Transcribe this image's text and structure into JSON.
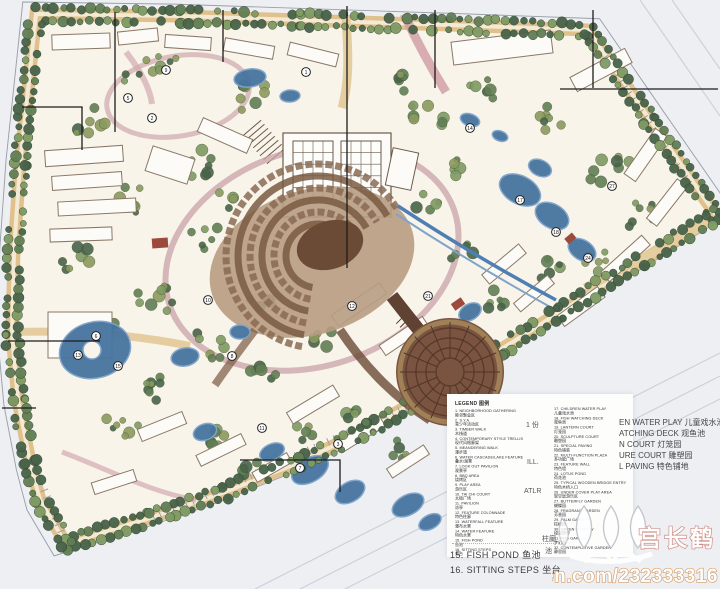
{
  "legend": {
    "heading": "LEGEND 图例",
    "left": [
      {
        "num": "1.",
        "en": "NEIGHBORHOOD GATHERING",
        "zh": "睦邻聚会区"
      },
      {
        "num": "2.",
        "en": "S.Y.A.",
        "zh": "青少年活动区"
      },
      {
        "num": "3.",
        "en": "TIMBER WALK",
        "zh": "木栈道"
      },
      {
        "num": "4.",
        "en": "CONTEMPORARY STYLE TRELLIS",
        "zh": "现代风格廊架"
      },
      {
        "num": "5.",
        "en": "MEANDERING WALK",
        "zh": "漫步道"
      },
      {
        "num": "6.",
        "en": "WATER CASCADE/LAKE FEATURE",
        "zh": "叠水/湖景"
      },
      {
        "num": "7.",
        "en": "LOOK OUT PAVILION",
        "zh": "观景亭"
      },
      {
        "num": "8.",
        "en": "BBQ AREA",
        "zh": "烧烤区"
      },
      {
        "num": "9.",
        "en": "PLAY AREA",
        "zh": "游乐区"
      },
      {
        "num": "10.",
        "en": "TAI CHI COURT",
        "zh": "太极广场"
      },
      {
        "num": "11.",
        "en": "PAVILION",
        "zh": "凉亭"
      },
      {
        "num": "12.",
        "en": "FEATURE COLONNADE",
        "zh": "特色柱廊"
      },
      {
        "num": "13.",
        "en": "WATERFALL FEATURE",
        "zh": "瀑布水景"
      },
      {
        "num": "14.",
        "en": "WATER FEATURE",
        "zh": "特色水景"
      },
      {
        "num": "15.",
        "en": "FISH POND",
        "zh": "鱼池"
      },
      {
        "num": "16.",
        "en": "SITTING STEPS",
        "zh": "坐台"
      }
    ],
    "right": [
      {
        "num": "17.",
        "en": "CHILDREN WATER PLAY",
        "zh": "儿童戏水池"
      },
      {
        "num": "18.",
        "en": "FISH WATCHING DECK",
        "zh": "观鱼池"
      },
      {
        "num": "19.",
        "en": "LANTERN COURT",
        "zh": "灯笼园"
      },
      {
        "num": "20.",
        "en": "SCULPTURE COURT",
        "zh": "雕塑园"
      },
      {
        "num": "21.",
        "en": "SPECIAL PAVING",
        "zh": "特色铺装"
      },
      {
        "num": "22.",
        "en": "MULTI-FUNCTION PLAZA",
        "zh": "多功能广场"
      },
      {
        "num": "23.",
        "en": "FEATURE WALL",
        "zh": "特色墙"
      },
      {
        "num": "24.",
        "en": "LOTUS POND",
        "zh": "荷花池"
      },
      {
        "num": "25.",
        "en": "TYPICAL WOODEN BRIDGE ENTRY",
        "zh": "特色木桥入口"
      },
      {
        "num": "26.",
        "en": "UNDER COVER PLAY AREA",
        "zh": "架空层游乐区"
      },
      {
        "num": "27.",
        "en": "BUTTERFLY GARDEN",
        "zh": "蝴蝶园"
      },
      {
        "num": "28.",
        "en": "FRAGRANT GARDEN",
        "zh": "芳香园"
      },
      {
        "num": "29.",
        "en": "PALM GARDEN",
        "zh": "棕榈园"
      },
      {
        "num": "30.",
        "en": "GREEN MEADOW",
        "zh": "绿茵草坪"
      },
      {
        "num": "31.",
        "en": "FOG GARDEN",
        "zh": "梦幻园"
      },
      {
        "num": "32.",
        "en": "CONTEMPLATIVE GARDEN",
        "zh": "静思园"
      }
    ],
    "bottom_lines": [
      "15. FISH POND 鱼池",
      "16. SITTING STEPS 坐台"
    ],
    "overlay_lines": [
      "EN WATER PLAY 儿童戏水池",
      "ATCHING DECK 观鱼池",
      "N COURT 灯笼园",
      "URE COURT 雕塑园",
      "L PAVING 特色铺地"
    ],
    "fragments": [
      {
        "text": "1 份",
        "x": 526,
        "y": 420
      },
      {
        "text": "ILL.",
        "x": 527,
        "y": 459
      },
      {
        "text": "ATLR",
        "x": 524,
        "y": 488
      },
      {
        "text": "柱廊",
        "x": 542,
        "y": 534
      },
      {
        "text": "池",
        "x": 545,
        "y": 546
      }
    ]
  },
  "watermark": {
    "name": "宫长鹤",
    "url": "renren.com/232333316",
    "logo": "three-cranes-logo"
  },
  "plan": {
    "markers": [
      {
        "n": "1",
        "x": 306,
        "y": 72
      },
      {
        "n": "9",
        "x": 166,
        "y": 70
      },
      {
        "n": "5",
        "x": 128,
        "y": 98
      },
      {
        "n": "2",
        "x": 152,
        "y": 118
      },
      {
        "n": "6",
        "x": 96,
        "y": 336
      },
      {
        "n": "13",
        "x": 78,
        "y": 355
      },
      {
        "n": "15",
        "x": 118,
        "y": 366
      },
      {
        "n": "10",
        "x": 208,
        "y": 300
      },
      {
        "n": "8",
        "x": 232,
        "y": 356
      },
      {
        "n": "11",
        "x": 262,
        "y": 428
      },
      {
        "n": "7",
        "x": 300,
        "y": 468
      },
      {
        "n": "3",
        "x": 338,
        "y": 444
      },
      {
        "n": "14",
        "x": 470,
        "y": 128
      },
      {
        "n": "17",
        "x": 520,
        "y": 200
      },
      {
        "n": "18",
        "x": 556,
        "y": 232
      },
      {
        "n": "24",
        "x": 588,
        "y": 258
      },
      {
        "n": "21",
        "x": 428,
        "y": 296
      },
      {
        "n": "27",
        "x": 612,
        "y": 186
      },
      {
        "n": "12",
        "x": 352,
        "y": 306
      }
    ],
    "colors": {
      "tree_dark": "#48634a",
      "tree_mid": "#617e55",
      "tree_light": "#7f9a63",
      "tree_olive": "#8b9a5e",
      "road_tan": "#e0c18c",
      "road_light": "#f3ead6",
      "water": "#46749f",
      "water_light": "#7fa3c9",
      "path_pink": "#cf9fa6",
      "path_pink2": "#d4aab0",
      "plaza_brown": "#7a5440",
      "plaza_dark": "#5a3b2b",
      "amph_base": "#b79c82",
      "amph_arc1": "#8a6a52",
      "amph_arc2": "#7a5a42",
      "amph_core": "#6b4b35",
      "building_fill": "#fcfbf7",
      "building_stroke": "#8a7867",
      "accent_red": "#9c4a3c",
      "site_paper": "#f8f4ea",
      "outside": "#edeff3",
      "leader": "#1c1c1c"
    }
  }
}
